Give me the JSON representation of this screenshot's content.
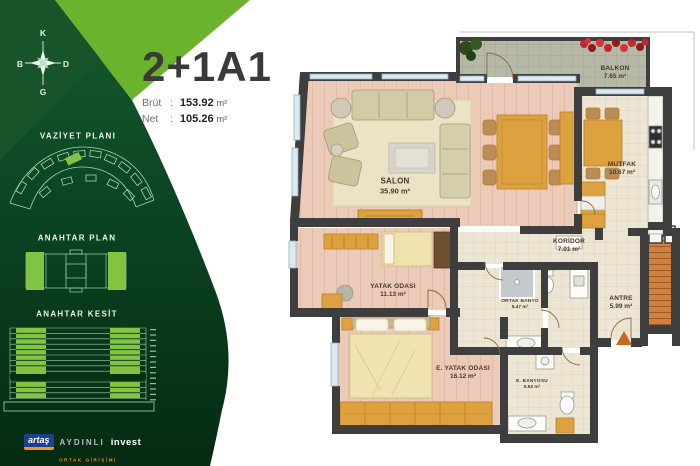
{
  "header": {
    "unit_code": "2+1A1",
    "rows": [
      {
        "label": "Brüt",
        "sep": ":",
        "value": "153.92",
        "unit": "m²"
      },
      {
        "label": "Net",
        "sep": ":",
        "value": "105.26",
        "unit": "m²"
      }
    ]
  },
  "sidebar": {
    "compass": {
      "n": "K",
      "e": "D",
      "s": "G",
      "w": "B"
    },
    "sections": {
      "site_plan": "VAZİYET PLANI",
      "key_plan": "ANAHTAR PLAN",
      "key_section": "ANAHTAR KESİT"
    },
    "logo": {
      "artas": "artaş",
      "aydinli": "AYDINLI",
      "invest": "invest",
      "tagline": "ORTAK GİRİŞİMİ"
    }
  },
  "floorplan": {
    "rooms": {
      "salon": {
        "name": "SALON",
        "area": "35.90 m²"
      },
      "mutfak": {
        "name": "MUTFAK",
        "area": "10.67 m²"
      },
      "balkon": {
        "name": "BALKON",
        "area": "7.65 m²"
      },
      "koridor": {
        "name": "KORİDOR",
        "area": "7.01 m²"
      },
      "antre": {
        "name": "ANTRE",
        "area": "5.99 m²"
      },
      "ortak_banyo": {
        "name": "ORTAK BANYO",
        "area": "5.47 m²"
      },
      "yatak": {
        "name": "YATAK ODASI",
        "area": "11.13 m²"
      },
      "e_yatak": {
        "name": "E. YATAK ODASI",
        "area": "16.12 m²"
      },
      "e_banyo": {
        "name": "E. BANYOSU",
        "area": "5.53 m²"
      }
    }
  },
  "colors": {
    "accent_green": "#6cb32d",
    "dark_green": "#0b4423",
    "line_green": "#9fd6ad",
    "wall": "#3e3e3e",
    "wood_floor": "#ebcbb8",
    "tile_floor": "#eee6d4",
    "balcony_floor": "#b7b9a7",
    "furniture_wood": "#dda23f",
    "logo_blue": "#1d3f8f",
    "logo_orange": "#f7941d"
  }
}
